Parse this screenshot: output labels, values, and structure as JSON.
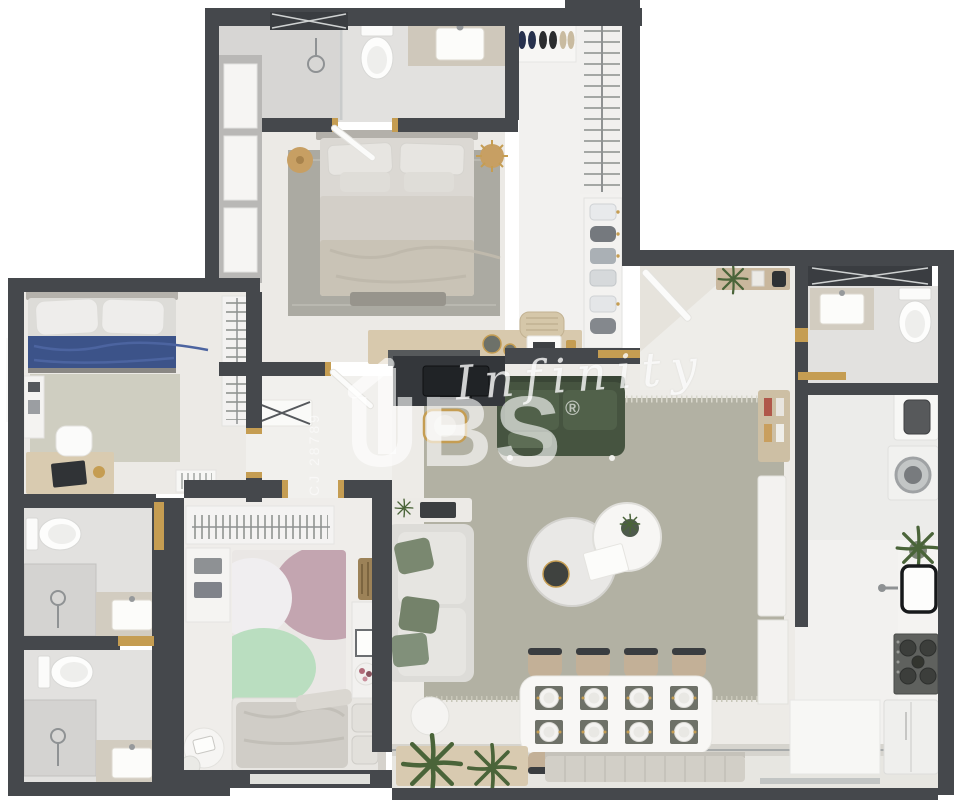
{
  "watermark": {
    "script": "Infinity",
    "brand_left": "U",
    "brand_right": "BS",
    "registered": "®",
    "vertical_code": "CJ 28789"
  },
  "palette": {
    "wall": "#45484c",
    "floor_light": "#f2f1ef",
    "floor_tile": "#e2e1df",
    "rug_living": "#b2b1a3",
    "sofa_green": "#465440",
    "bed_blue": "#3c5389",
    "accent_gold": "#c59d52",
    "kids_rug_pink": "#c3a5b0",
    "kids_rug_green": "#badec0",
    "watermark_white": "rgba(255,255,255,0.65)"
  }
}
